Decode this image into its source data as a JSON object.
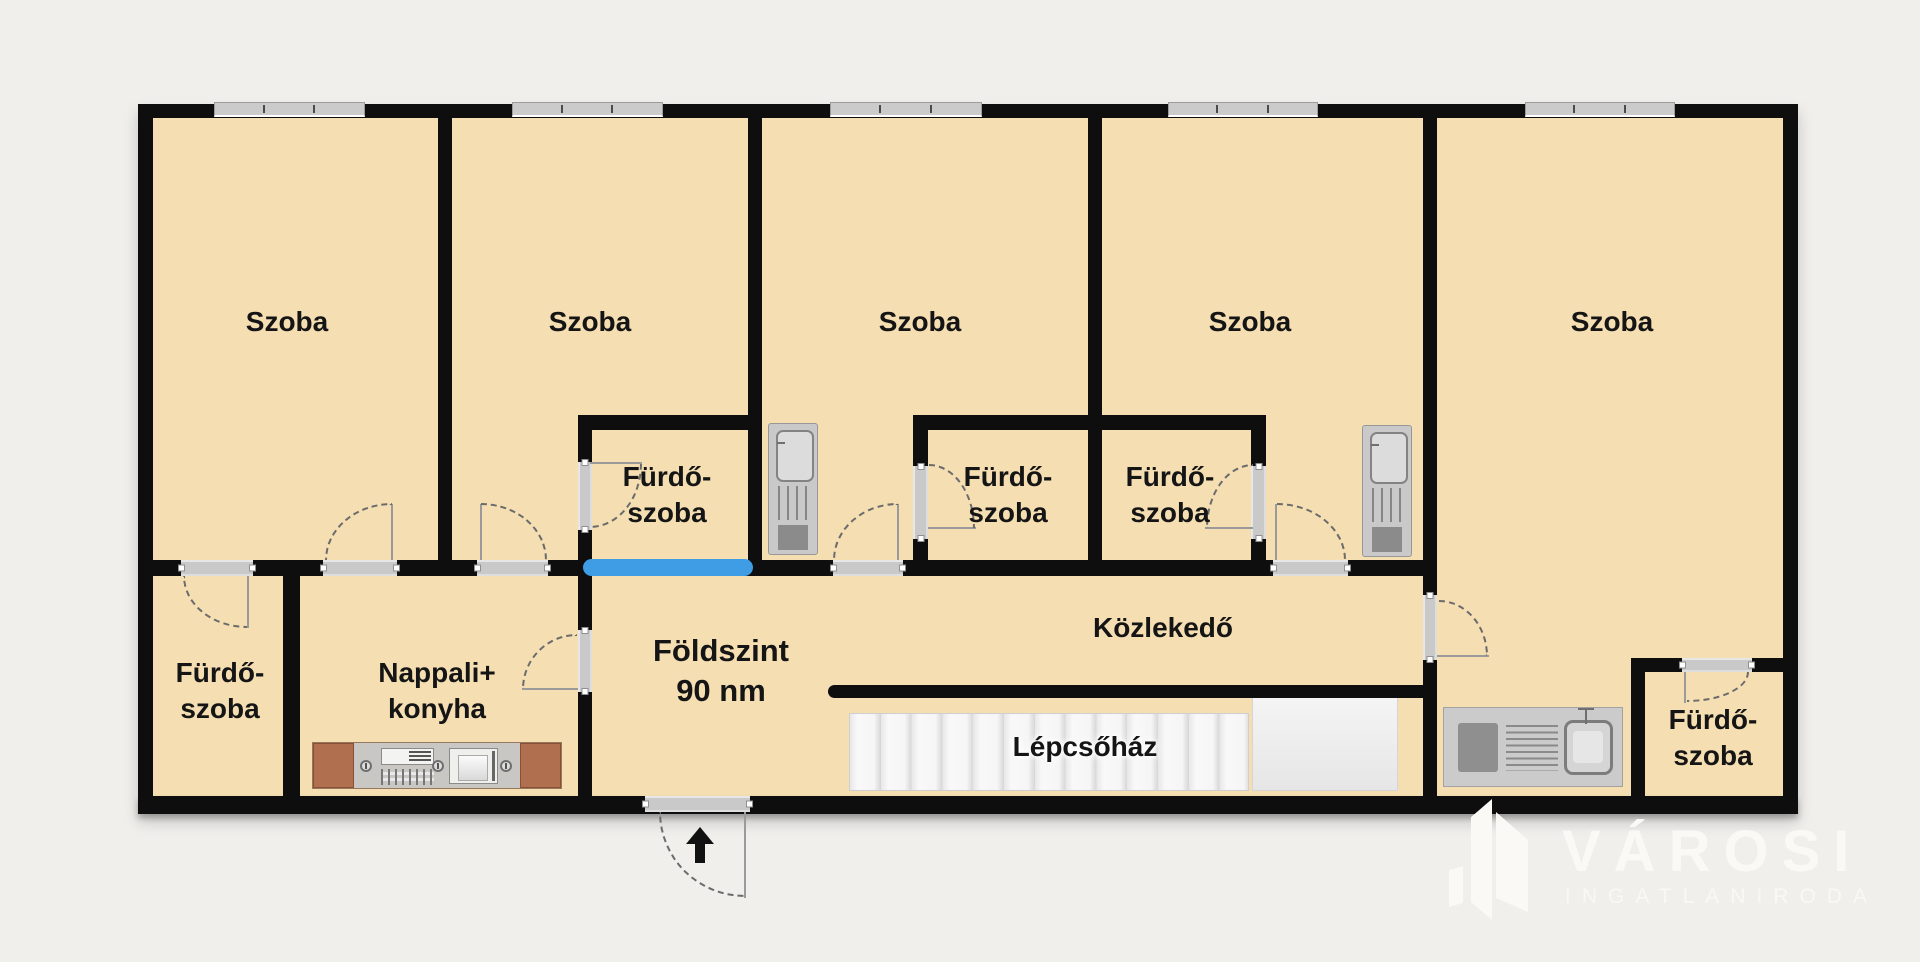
{
  "labels": {
    "bedroom": {
      "label": "Szoba"
    },
    "bathroom": {
      "line1": "Fürdő-",
      "line2": "szoba"
    },
    "living": {
      "line1": "Nappali+",
      "line2": "konyha"
    },
    "floor": {
      "line1": "Földszint",
      "line2": "90 nm"
    },
    "corridor": {
      "label": "Közlekedő"
    },
    "stairwell": {
      "label": "Lépcsőház"
    }
  },
  "logo": {
    "brand": "VÁROSI",
    "tagline": "INGATLANIRODA"
  },
  "colors": {
    "bg": "#f0efec",
    "room": "#f4deb2",
    "wall": "#0e0e0e",
    "opening": "#c9c9c9",
    "window": "#cbcbcb",
    "highlight": "#3f9de6",
    "counter_brown": "#b06f4e",
    "fixture": "#c9c9c9",
    "text": "#151515",
    "logo": "#faf9f6"
  }
}
